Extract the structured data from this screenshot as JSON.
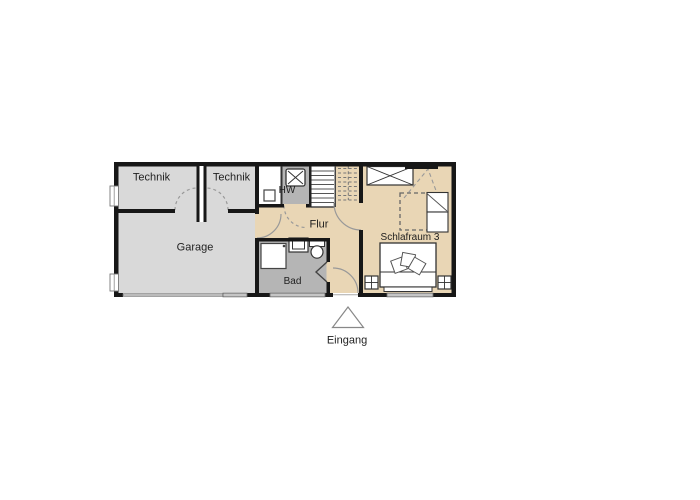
{
  "plan": {
    "rooms": {
      "technik_left": "Technik",
      "technik_right": "Technik",
      "hw": "HW",
      "flur": "Flur",
      "garage": "Garage",
      "bad": "Bad",
      "schlafraum": "Schlafraum 3"
    },
    "entrance_label": "Eingang"
  },
  "colors": {
    "room_gray_light": "#d9d9d9",
    "room_gray_dark": "#b5b5b5",
    "floor_beige": "#e9d6b5",
    "wall_black": "#171717",
    "door_arc_gray": "#999999",
    "window_fill": "#e9e9e9"
  }
}
